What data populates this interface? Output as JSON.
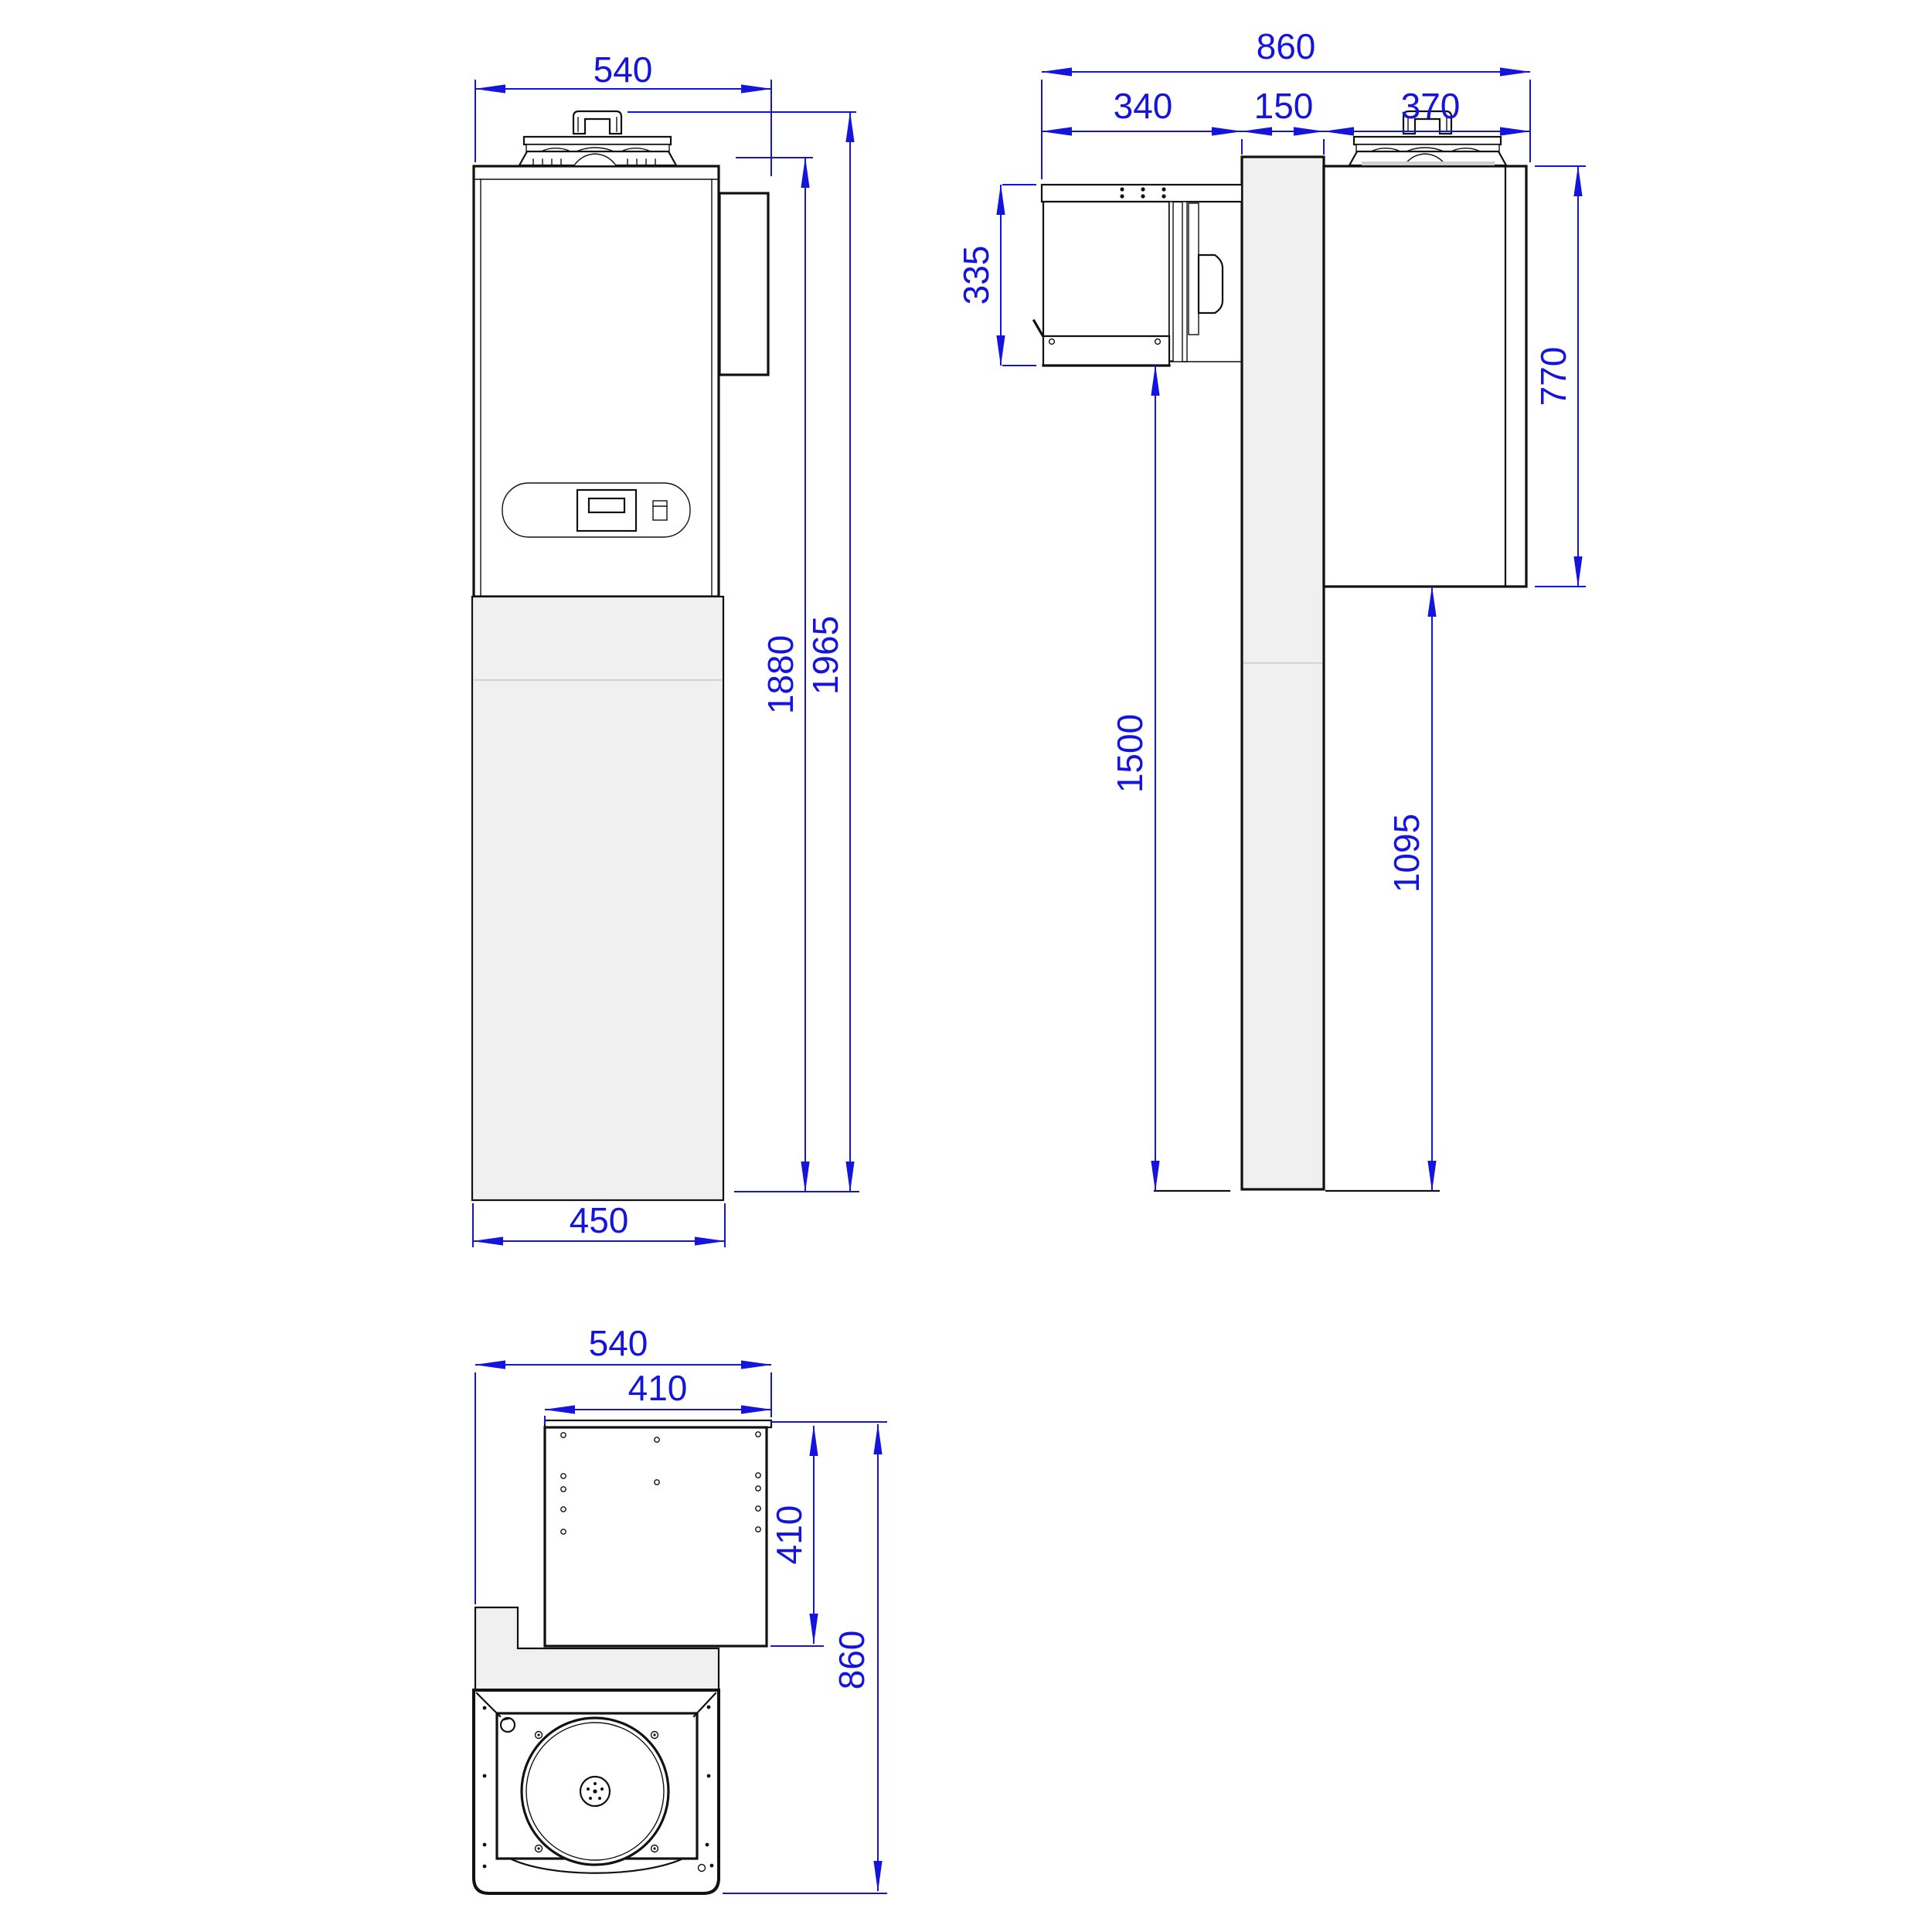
{
  "views": {
    "front": {
      "dims": {
        "top_width": "540",
        "bottom_width": "450",
        "inner_height": "1880",
        "overall_height": "1965"
      }
    },
    "side": {
      "dims": {
        "overall_depth": "860",
        "inside_depth": "340",
        "wall_thickness": "150",
        "outside_depth": "370",
        "inside_unit_height": "335",
        "outside_unit_height": "770",
        "inside_floor_clearance": "1500",
        "outside_floor_clearance": "1095"
      }
    },
    "top": {
      "dims": {
        "overall_width": "540",
        "inner_width": "410",
        "inner_depth": "410",
        "overall_depth": "860"
      }
    }
  },
  "colors": {
    "dimension_blue": "#1414dd",
    "line_black": "#111111",
    "panel_gray": "#f0f0f0"
  }
}
